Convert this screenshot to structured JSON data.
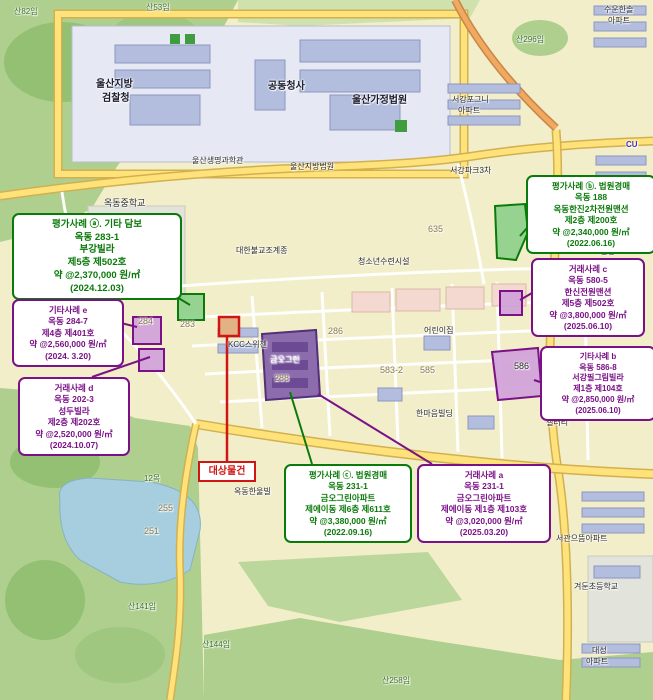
{
  "colors": {
    "case_green": "#0a7a0a",
    "case_purple": "#7a1186",
    "subject_red": "#d01515",
    "residential": "#f2eec9",
    "forest": "#aecf8e",
    "water": "#a6cede",
    "road_yellow": "#ffe27a",
    "government_complex": "#b3bedf",
    "highlight_green": "#86cc86",
    "highlight_purple": "#cf9fd9"
  },
  "annotations": {
    "subject_label": "대상물건",
    "cases": [
      {
        "name": "appraisal-case-a",
        "style": "green",
        "lines": [
          "평가사례 ⓐ. 기타 담보",
          "옥동 283-1",
          "부강빌라",
          "제5층 제502호",
          "약 @2,370,000 원/㎡",
          "(2024.12.03)"
        ]
      },
      {
        "name": "other-case-e",
        "style": "purple",
        "lines": [
          "기타사례 e",
          "옥동 284-7",
          "제4층 제401호",
          "약 @2,560,000 원/㎡",
          "(2024. 3.20)"
        ]
      },
      {
        "name": "sale-case-d",
        "style": "purple",
        "lines": [
          "거래사례 d",
          "옥동 202-3",
          "성두빌라",
          "제2층 제202호",
          "약 @2,520,000 원/㎡",
          "(2024.10.07)"
        ]
      },
      {
        "name": "appraisal-case-b",
        "style": "green",
        "lines": [
          "평가사례 ⓑ. 법원경매",
          "옥동 188",
          "옥동한진2차전원맨션",
          "제2층 제200호",
          "약 @2,340,000 원/㎡",
          "(2022.06.16)"
        ]
      },
      {
        "name": "sale-case-c",
        "style": "purple",
        "lines": [
          "거래사례 c",
          "옥동 580-5",
          "한신전원맨션",
          "제5층 제502호",
          "약 @3,800,000 원/㎡",
          "(2025.06.10)"
        ]
      },
      {
        "name": "other-case-b",
        "style": "purple",
        "lines": [
          "기타사례 b",
          "옥동 586-8",
          "서강필그림빌라",
          "제1층 제104호",
          "약 @2,850,000 원/㎡",
          "(2025.06.10)"
        ]
      },
      {
        "name": "appraisal-case-c",
        "style": "green",
        "lines": [
          "평가사례 ⓒ. 법원경매",
          "옥동 231-1",
          "금오그린아파트",
          "제에이동 제6층 제611호",
          "약 @3,380,000 원/㎡",
          "(2022.09.16)"
        ]
      },
      {
        "name": "sale-case-a",
        "style": "purple",
        "lines": [
          "거래사례 a",
          "옥동 231-1",
          "금오그린아파트",
          "제에이동 제1층 제103호",
          "약 @3,020,000 원/㎡",
          "(2025.03.20)"
        ]
      }
    ]
  },
  "map": {
    "labels": [
      {
        "text": "산82임",
        "x": 14,
        "y": 8,
        "color": "#3f6f2f",
        "size": 8
      },
      {
        "text": "산53임",
        "x": 146,
        "y": 4,
        "color": "#3f6f2f",
        "size": 8
      },
      {
        "text": "수운한솔",
        "x": 604,
        "y": 6,
        "color": "#2b2b2b",
        "size": 8
      },
      {
        "text": "아파트",
        "x": 608,
        "y": 17,
        "color": "#2b2b2b",
        "size": 8
      },
      {
        "text": "산296임",
        "x": 516,
        "y": 36,
        "color": "#3f6f2f",
        "size": 8
      },
      {
        "text": "울산지방",
        "x": 96,
        "y": 80,
        "color": "#1a1a2e",
        "size": 10,
        "bold": true
      },
      {
        "text": "검찰청",
        "x": 102,
        "y": 94,
        "color": "#1a1a2e",
        "size": 10,
        "bold": true
      },
      {
        "text": "공동청사",
        "x": 268,
        "y": 82,
        "color": "#1a1a2e",
        "size": 10,
        "bold": true
      },
      {
        "text": "울산가정법원",
        "x": 352,
        "y": 96,
        "color": "#1a1a2e",
        "size": 10,
        "bold": true
      },
      {
        "text": "서강포그니",
        "x": 452,
        "y": 96,
        "color": "#2b2b2b",
        "size": 8
      },
      {
        "text": "아파트",
        "x": 458,
        "y": 107,
        "color": "#2b2b2b",
        "size": 8
      },
      {
        "text": "울산생명과학관",
        "x": 192,
        "y": 157,
        "color": "#2b2b2b",
        "size": 8
      },
      {
        "text": "울산지방법원",
        "x": 290,
        "y": 163,
        "color": "#2b2b2b",
        "size": 8
      },
      {
        "text": "서강파크3차",
        "x": 450,
        "y": 167,
        "color": "#2b2b2b",
        "size": 8
      },
      {
        "text": "CU",
        "x": 626,
        "y": 141,
        "color": "#4433bb",
        "size": 8,
        "bold": true
      },
      {
        "text": "옥동중학교",
        "x": 104,
        "y": 199,
        "color": "#2b2b2b",
        "size": 9
      },
      {
        "text": "639학",
        "x": 134,
        "y": 257,
        "color": "#8a7a50",
        "size": 8
      },
      {
        "text": "635",
        "x": 428,
        "y": 225,
        "color": "#8a7a50",
        "size": 9
      },
      {
        "text": "한진전원",
        "x": 590,
        "y": 237,
        "color": "#2b2b2b",
        "size": 8
      },
      {
        "text": "맨션",
        "x": 600,
        "y": 248,
        "color": "#2b2b2b",
        "size": 8
      },
      {
        "text": "대한불교조계종",
        "x": 236,
        "y": 247,
        "color": "#2b2b2b",
        "size": 8
      },
      {
        "text": "청소년수련시설",
        "x": 358,
        "y": 258,
        "color": "#2b2b2b",
        "size": 8
      },
      {
        "text": "580",
        "x": 550,
        "y": 279,
        "color": "#8a7a50",
        "size": 9
      },
      {
        "text": "284",
        "x": 138,
        "y": 317,
        "color": "#8a7a50",
        "size": 9
      },
      {
        "text": "283",
        "x": 180,
        "y": 320,
        "color": "#8a7a50",
        "size": 9
      },
      {
        "text": "286",
        "x": 328,
        "y": 327,
        "color": "#8a7a50",
        "size": 9
      },
      {
        "text": "288",
        "x": 274,
        "y": 374,
        "color": "#8a7a50",
        "size": 9
      },
      {
        "text": "KCC스위첸",
        "x": 228,
        "y": 341,
        "color": "#2b2b2b",
        "size": 8
      },
      {
        "text": "금오그린",
        "x": 270,
        "y": 356,
        "color": "#ffffff",
        "size": 8
      },
      {
        "text": "어린이집",
        "x": 424,
        "y": 327,
        "color": "#2b2b2b",
        "size": 8
      },
      {
        "text": "583-2",
        "x": 380,
        "y": 366,
        "color": "#8a7a50",
        "size": 9
      },
      {
        "text": "585",
        "x": 420,
        "y": 366,
        "color": "#8a7a50",
        "size": 9
      },
      {
        "text": "586",
        "x": 514,
        "y": 362,
        "color": "#2b2b2b",
        "size": 9
      },
      {
        "text": "한마음빌딩",
        "x": 416,
        "y": 410,
        "color": "#2b2b2b",
        "size": 8
      },
      {
        "text": "갤러리",
        "x": 546,
        "y": 419,
        "color": "#2b2b2b",
        "size": 8
      },
      {
        "text": "12목",
        "x": 144,
        "y": 475,
        "color": "#3f6f2f",
        "size": 8
      },
      {
        "text": "255",
        "x": 158,
        "y": 504,
        "color": "#8a7a50",
        "size": 9
      },
      {
        "text": "251",
        "x": 144,
        "y": 527,
        "color": "#8a7a50",
        "size": 9
      },
      {
        "text": "옥동한울빌",
        "x": 234,
        "y": 488,
        "color": "#2b2b2b",
        "size": 8
      },
      {
        "text": "서관으뜸아파트",
        "x": 556,
        "y": 535,
        "color": "#2b2b2b",
        "size": 8
      },
      {
        "text": "겨둔초등학교",
        "x": 574,
        "y": 583,
        "color": "#2b2b2b",
        "size": 8
      },
      {
        "text": "산141임",
        "x": 128,
        "y": 603,
        "color": "#3f6f2f",
        "size": 8
      },
      {
        "text": "산144임",
        "x": 202,
        "y": 641,
        "color": "#3f6f2f",
        "size": 8
      },
      {
        "text": "산258임",
        "x": 382,
        "y": 677,
        "color": "#3f6f2f",
        "size": 8
      },
      {
        "text": "대성",
        "x": 592,
        "y": 647,
        "color": "#2b2b2b",
        "size": 8
      },
      {
        "text": "아파트",
        "x": 586,
        "y": 658,
        "color": "#2b2b2b",
        "size": 8
      }
    ]
  }
}
